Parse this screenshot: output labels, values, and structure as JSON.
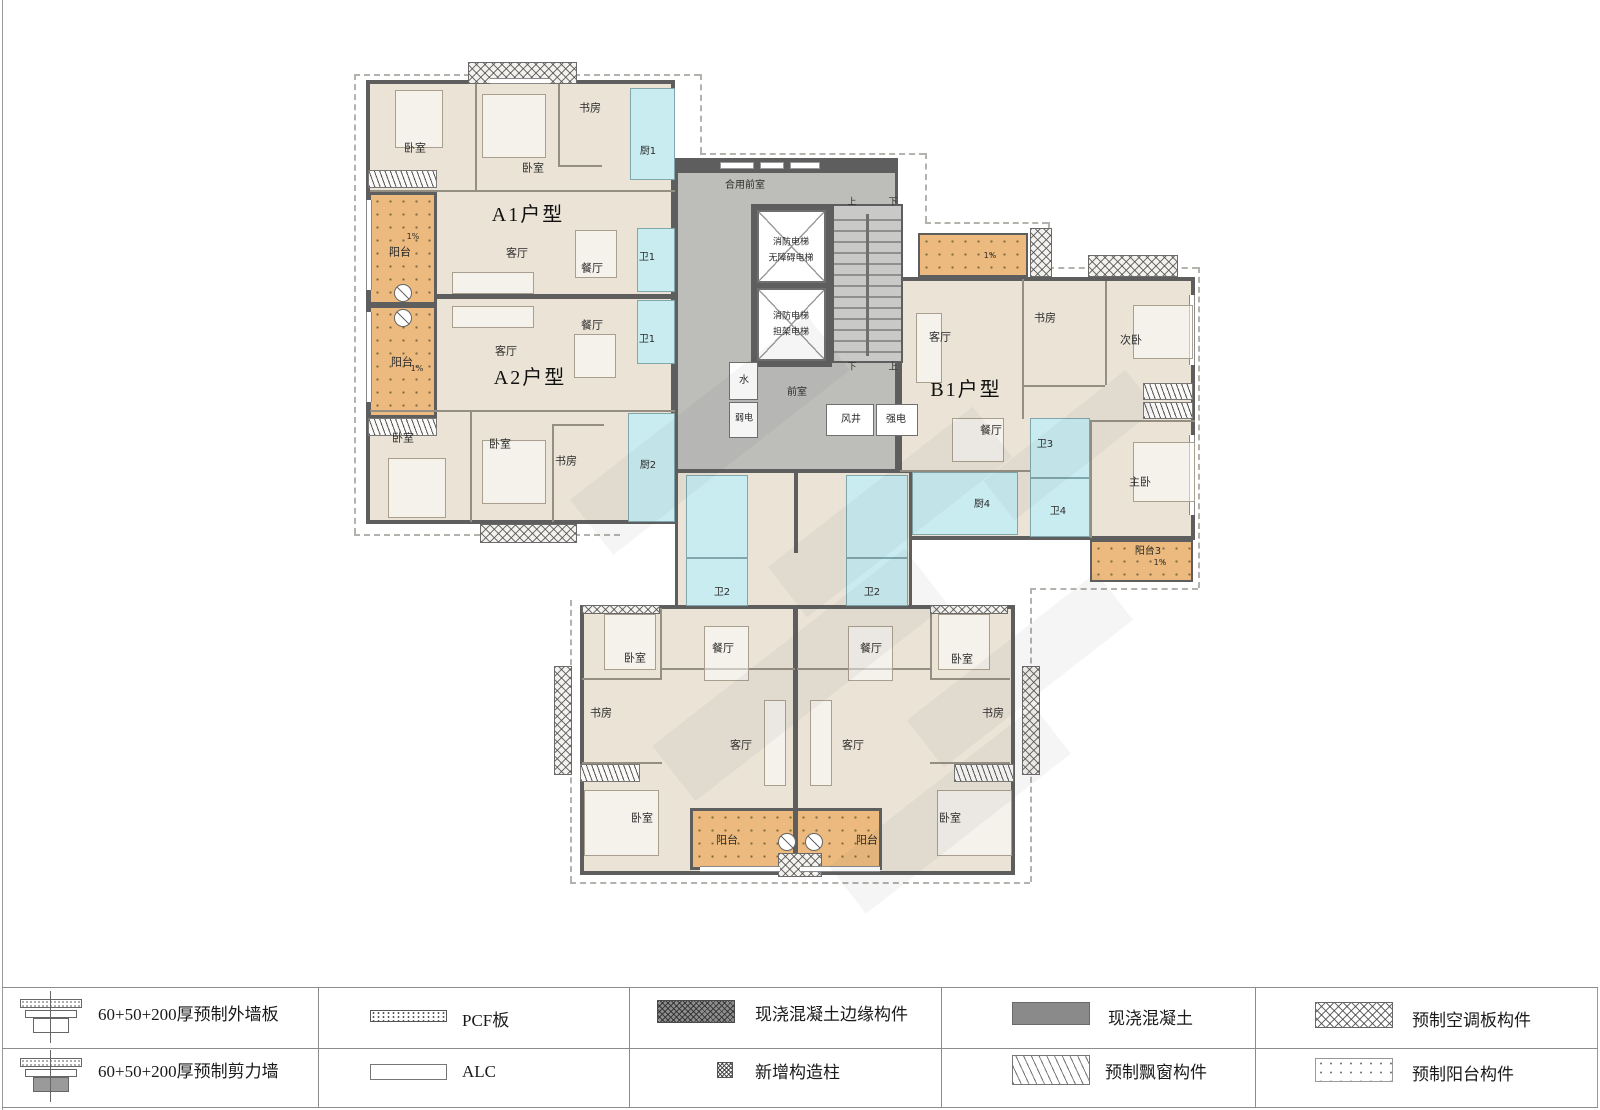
{
  "units": {
    "a1": "A1户型",
    "a2": "A2户型",
    "b1": "B1户型"
  },
  "core": {
    "shared_lobby": "合用前室",
    "lobby": "前室",
    "elevator1": [
      "消防电梯",
      "无障碍电梯"
    ],
    "elevator2": [
      "消防电梯",
      "担架电梯"
    ],
    "water": "水",
    "weak_power": "弱电",
    "air_shaft": "风井",
    "strong_power": "强电",
    "up": "上",
    "down": "下"
  },
  "colors": {
    "floor": "#EAE3D6",
    "balcony": "#ECBA7E",
    "wet": "#C9ECF1",
    "core": "#BDBDBA",
    "wall": "#5E5E5E"
  },
  "plan": {
    "labels": [
      {
        "t": "A1户型",
        "x": 528,
        "y": 215,
        "fs": 20,
        "k": "title"
      },
      {
        "t": "A2户型",
        "x": 530,
        "y": 378,
        "fs": 20,
        "k": "title"
      },
      {
        "t": "B1户型",
        "x": 966,
        "y": 390,
        "fs": 20,
        "k": "title"
      },
      {
        "t": "卧室",
        "x": 415,
        "y": 148,
        "fs": 11
      },
      {
        "t": "卧室",
        "x": 533,
        "y": 168,
        "fs": 11
      },
      {
        "t": "书房",
        "x": 590,
        "y": 108,
        "fs": 11
      },
      {
        "t": "厨1",
        "x": 648,
        "y": 152,
        "fs": 10
      },
      {
        "t": "客厅",
        "x": 517,
        "y": 253,
        "fs": 11
      },
      {
        "t": "餐厅",
        "x": 592,
        "y": 268,
        "fs": 11
      },
      {
        "t": "卫1",
        "x": 647,
        "y": 258,
        "fs": 10
      },
      {
        "t": "阳台",
        "x": 400,
        "y": 252,
        "fs": 11
      },
      {
        "t": "餐厅",
        "x": 592,
        "y": 325,
        "fs": 11
      },
      {
        "t": "卫1",
        "x": 647,
        "y": 340,
        "fs": 10
      },
      {
        "t": "客厅",
        "x": 506,
        "y": 351,
        "fs": 11
      },
      {
        "t": "阳台",
        "x": 402,
        "y": 362,
        "fs": 11
      },
      {
        "t": "卧室",
        "x": 403,
        "y": 438,
        "fs": 11
      },
      {
        "t": "卧室",
        "x": 500,
        "y": 444,
        "fs": 11
      },
      {
        "t": "书房",
        "x": 566,
        "y": 461,
        "fs": 11
      },
      {
        "t": "厨2",
        "x": 648,
        "y": 466,
        "fs": 10
      },
      {
        "t": "合用前室",
        "x": 745,
        "y": 186,
        "fs": 10
      },
      {
        "t": "消防电梯",
        "x": 791,
        "y": 243,
        "fs": 9
      },
      {
        "t": "无障碍电梯",
        "x": 791,
        "y": 259,
        "fs": 9
      },
      {
        "t": "消防电梯",
        "x": 791,
        "y": 317,
        "fs": 9
      },
      {
        "t": "担架电梯",
        "x": 791,
        "y": 333,
        "fs": 9
      },
      {
        "t": "水",
        "x": 744,
        "y": 381,
        "fs": 10
      },
      {
        "t": "弱电",
        "x": 744,
        "y": 419,
        "fs": 9
      },
      {
        "t": "前室",
        "x": 797,
        "y": 393,
        "fs": 10
      },
      {
        "t": "风井",
        "x": 851,
        "y": 420,
        "fs": 10
      },
      {
        "t": "强电",
        "x": 896,
        "y": 420,
        "fs": 10
      },
      {
        "t": "上",
        "x": 852,
        "y": 203,
        "fs": 9
      },
      {
        "t": "下",
        "x": 893,
        "y": 203,
        "fs": 9
      },
      {
        "t": "下",
        "x": 852,
        "y": 368,
        "fs": 9
      },
      {
        "t": "上",
        "x": 893,
        "y": 368,
        "fs": 9
      },
      {
        "t": "客厅",
        "x": 940,
        "y": 337,
        "fs": 11
      },
      {
        "t": "书房",
        "x": 1045,
        "y": 318,
        "fs": 11
      },
      {
        "t": "次卧",
        "x": 1131,
        "y": 340,
        "fs": 11
      },
      {
        "t": "餐厅",
        "x": 991,
        "y": 430,
        "fs": 11
      },
      {
        "t": "卫3",
        "x": 1045,
        "y": 445,
        "fs": 10
      },
      {
        "t": "主卧",
        "x": 1140,
        "y": 482,
        "fs": 11
      },
      {
        "t": "厨4",
        "x": 982,
        "y": 505,
        "fs": 10
      },
      {
        "t": "卫4",
        "x": 1058,
        "y": 512,
        "fs": 10
      },
      {
        "t": "阳台3",
        "x": 1148,
        "y": 552,
        "fs": 10
      },
      {
        "t": "卫2",
        "x": 722,
        "y": 593,
        "fs": 10
      },
      {
        "t": "卫2",
        "x": 872,
        "y": 593,
        "fs": 10
      },
      {
        "t": "餐厅",
        "x": 723,
        "y": 648,
        "fs": 11
      },
      {
        "t": "餐厅",
        "x": 871,
        "y": 648,
        "fs": 11
      },
      {
        "t": "卧室",
        "x": 635,
        "y": 658,
        "fs": 11
      },
      {
        "t": "卧室",
        "x": 962,
        "y": 659,
        "fs": 11
      },
      {
        "t": "书房",
        "x": 601,
        "y": 713,
        "fs": 11
      },
      {
        "t": "书房",
        "x": 993,
        "y": 713,
        "fs": 11
      },
      {
        "t": "客厅",
        "x": 741,
        "y": 745,
        "fs": 11
      },
      {
        "t": "客厅",
        "x": 853,
        "y": 745,
        "fs": 11
      },
      {
        "t": "卧室",
        "x": 642,
        "y": 818,
        "fs": 11
      },
      {
        "t": "卧室",
        "x": 950,
        "y": 818,
        "fs": 11
      },
      {
        "t": "阳台",
        "x": 727,
        "y": 840,
        "fs": 11
      },
      {
        "t": "阳台",
        "x": 867,
        "y": 840,
        "fs": 11
      },
      {
        "t": "1%",
        "x": 990,
        "y": 256,
        "fs": 8
      },
      {
        "t": "1%",
        "x": 1160,
        "y": 563,
        "fs": 8
      },
      {
        "t": "1%",
        "x": 413,
        "y": 237,
        "fs": 8
      },
      {
        "t": "1%",
        "x": 417,
        "y": 369,
        "fs": 8
      }
    ]
  },
  "legend": {
    "items": [
      {
        "label": "60+50+200厚预制外墙板"
      },
      {
        "label": "60+50+200厚预制剪力墙"
      },
      {
        "label": "PCF板"
      },
      {
        "label": "ALC"
      },
      {
        "label": "现浇混凝土边缘构件"
      },
      {
        "label": "新增构造柱"
      },
      {
        "label": "现浇混凝土"
      },
      {
        "label": "预制飘窗构件"
      },
      {
        "label": "预制空调板构件"
      },
      {
        "label": "预制阳台构件"
      }
    ]
  }
}
